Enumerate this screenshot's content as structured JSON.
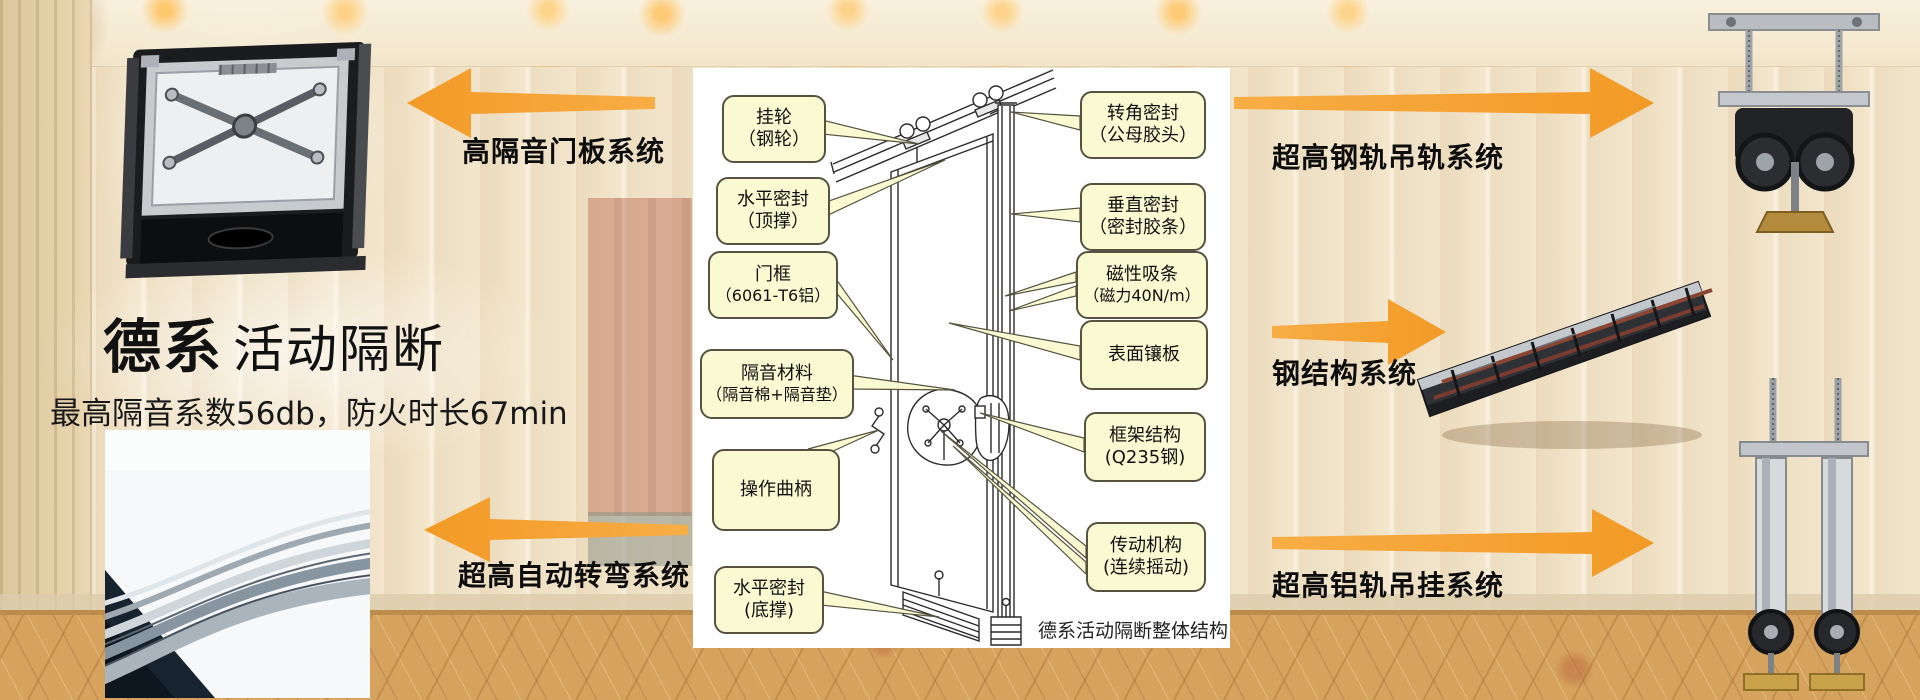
{
  "headline": {
    "brand": "德系",
    "product": "活动隔断",
    "subtitle": "最高隔音系数56db，防火时长67min"
  },
  "features": {
    "door_panel": "高隔音门板系统",
    "auto_turning": "超高自动转弯系统",
    "steel_rail": "超高钢轨吊轨系统",
    "steel_structure": "钢结构系统",
    "aluminum_rail": "超高铝轨吊挂系统"
  },
  "diagram": {
    "caption": "德系活动隔断整体结构",
    "callouts_left": [
      {
        "line1": "挂轮",
        "line2": "（钢轮）"
      },
      {
        "line1": "水平密封",
        "line2": "（顶撑）"
      },
      {
        "line1": "门框",
        "line2": "（6061-T6铝）"
      },
      {
        "line1": "隔音材料",
        "line2": "（隔音棉+隔音垫）"
      },
      {
        "line1": "操作曲柄",
        "line2": ""
      },
      {
        "line1": "水平密封",
        "line2": "(底撑)"
      }
    ],
    "callouts_right": [
      {
        "line1": "转角密封",
        "line2": "（公母胶头）"
      },
      {
        "line1": "垂直密封",
        "line2": "（密封胶条）"
      },
      {
        "line1": "磁性吸条",
        "line2": "（磁力40N/m）"
      },
      {
        "line1": "表面镶板",
        "line2": ""
      },
      {
        "line1": "框架结构",
        "line2": "(Q235钢)"
      },
      {
        "line1": "传动机构",
        "line2": "(连续摇动)"
      }
    ]
  },
  "colors": {
    "arrow_orange": "#F5A02E",
    "callout_fill": "#FAFAD2",
    "callout_border": "#55533F",
    "carpet": "#D6A35E",
    "wall_cream": "#F3E6CC"
  }
}
